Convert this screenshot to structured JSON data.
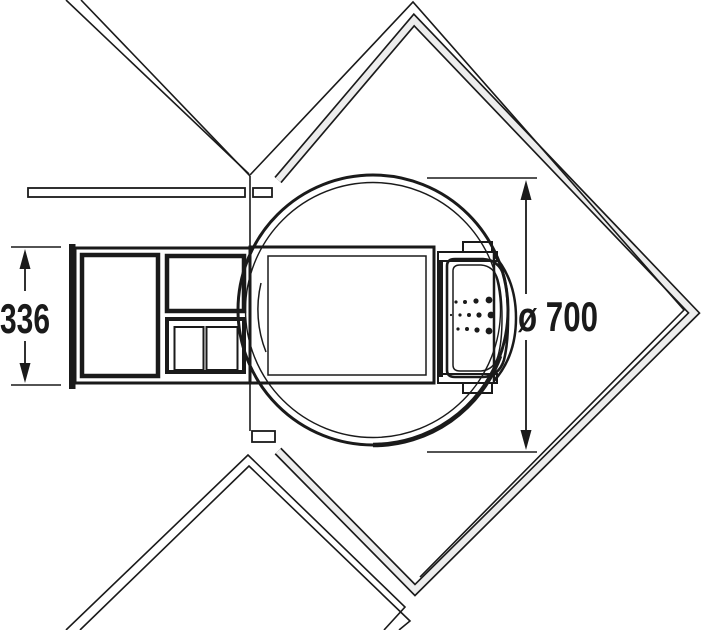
{
  "diagram": {
    "title": "corner-carousel-waste-unit-plan-view",
    "type": "technical-plan-view",
    "dimensions": {
      "pullout_width": {
        "label": "336"
      },
      "carousel_diameter": {
        "label": "ø 700"
      }
    },
    "colors": {
      "line": "#1a1a1a",
      "background": "#ffffff",
      "carousel_fill": "#dcdcdc",
      "platform_fill": "#d9d9d9",
      "tray_fill": "#e3e3e3",
      "unit_fill": "#e0e0e0",
      "bin_fill": "#ababab",
      "container_fill": "#d4d4d4",
      "inner_box_fill": "#d0d0d0",
      "panel_fill": "#e9e9e9",
      "band_fill": "#ededed",
      "door_fill": "#dcdcdc",
      "hinge_fill": "#e6e6e6"
    }
  }
}
